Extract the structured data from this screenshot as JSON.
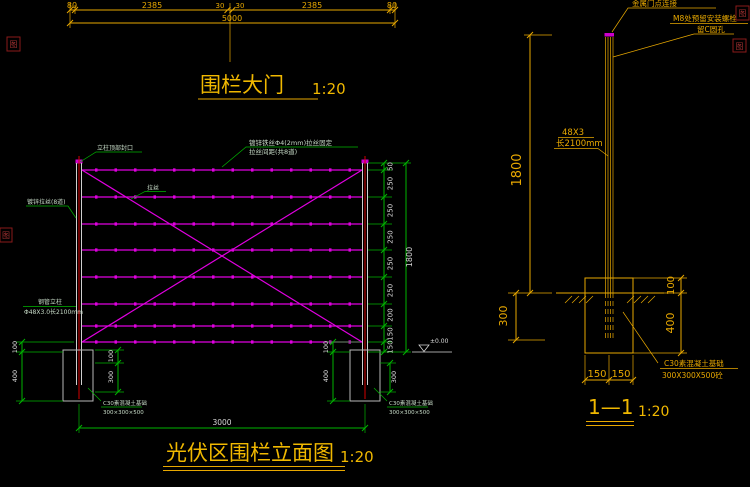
{
  "colors": {
    "background": "#000000",
    "dim_yellow": "#e8a800",
    "title_yellow": "#f0b800",
    "dim_green": "#00b400",
    "wire_magenta": "#e000e0",
    "post_white": "#cfcfcf",
    "post_red": "#d40000",
    "stamp_red": "#8a1a1a"
  },
  "gate": {
    "title": "围栏大门",
    "scale": "1:20",
    "dim_row": [
      "80",
      "2385",
      "30",
      "30",
      "2385",
      "80"
    ],
    "overall": "5000"
  },
  "gate_notes": {
    "note_1": "金属门点连接",
    "note_2": "M8处预留安装螺栓",
    "note_3": "留C圆孔"
  },
  "elevation": {
    "title": "光伏区围栏立面图",
    "scale": "1:20",
    "overall_width": "3000",
    "overall_height": "1800",
    "level": "±0.00",
    "segment_dims": [
      "50",
      "250",
      "250",
      "250",
      "250",
      "250",
      "200",
      "150",
      "150"
    ],
    "left_outer_dims": [
      "100",
      "400"
    ],
    "left_inner_dims": [
      "100",
      "300"
    ],
    "right_outer_dims": [
      "100",
      "400"
    ],
    "right_inner_dim": "300",
    "notes": {
      "post_top": "立柱顶部封口",
      "wire_rows": "镀锌拉丝(8道)",
      "wire": "拉丝",
      "wire_spec_1": "镀锌铁丝Φ4(2mm)拉丝固定",
      "wire_spec_2": "拉丝间距(共8道)",
      "post_spec_1": "钢管立柱",
      "post_spec_2": "Φ48X3.0长2100mm",
      "footing_1": "C30素混凝土基础",
      "footing_2": "300×300×500"
    }
  },
  "section": {
    "title": "1—1",
    "scale": "1:20",
    "height": "1800",
    "post_size": "48X3",
    "post_length": "长2100mm",
    "embed_depth": "300",
    "right_dims": [
      "100",
      "400"
    ],
    "bottom_dims": [
      "150",
      "150"
    ],
    "footing_note_1": "C30素混凝土基础",
    "footing_note_2": "300X300X500砼"
  },
  "stamps": {
    "glyph": "图"
  }
}
